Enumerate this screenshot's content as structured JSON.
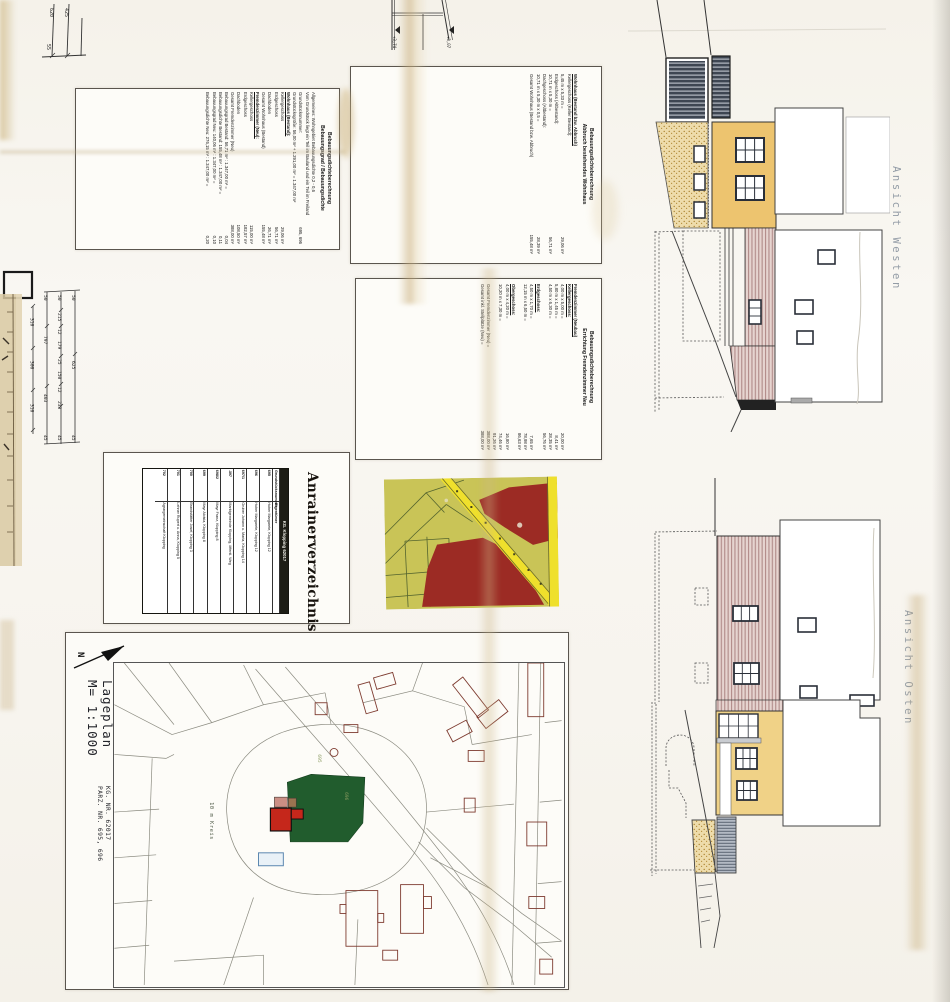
{
  "dims": {
    "t": [
      "620",
      "425",
      "55"
    ],
    "m1": [
      "310",
      "300",
      "310"
    ],
    "m2": [
      "50",
      "797",
      "403",
      "45"
    ],
    "m3": [
      "50",
      "215",
      "12",
      "179",
      "25",
      "150",
      "12",
      "233",
      "45"
    ],
    "m4": [
      "50",
      "625",
      "45"
    ]
  },
  "levels": [
    "+3,74",
    "+3,07"
  ],
  "panels": {
    "p1": {
      "title1": "Bebauungsdichteberechnung",
      "title2": "Bebauungsgrad / Bebauungsdichte",
      "rows": [
        {
          "t": "Allgemeines: Wohngebiet Bebauungsdichte 0,2 - 0,6",
          "v": ""
        },
        {
          "t": "Vom Grundstück liegt ein Teil im Bauland und ein Teil im Freiland",
          "v": ""
        },
        {
          "t": "Grundstücksnummer:",
          "v": "695, 696"
        },
        {
          "t": "Grundstücksgröße:  56,00 m² + 1.291,00 m² = 1.347,00 m²",
          "v": ""
        },
        {
          "t": "Wohnhaus (Bestand):",
          "v": "",
          "b": 1
        },
        {
          "t": "Kellergeschoss",
          "v": "29,06 m²"
        },
        {
          "t": "Erdgeschoss",
          "v": "56,71 m²"
        },
        {
          "t": "Dachboden",
          "v": "26,71 m²"
        },
        {
          "t": "Gesamt Wohnhaus (Bestand)",
          "v": "155,48 m²"
        },
        {
          "t": "Fremdenzimmer (Neu):",
          "v": "",
          "b": 1
        },
        {
          "t": "Kellergeschoss",
          "v": "115,00 m²"
        },
        {
          "t": "Erdgeschoss",
          "v": "182,57 m²"
        },
        {
          "t": "Dachboden",
          "v": "108,50 m²"
        },
        {
          "t": "Gesamt Fremdenzimmer (Neu)",
          "v": "388,00 m²"
        },
        {
          "t": "Bebauungsgrad Bestand:  56,71 m² : 1.347,00 m² =",
          "v": "0,04"
        },
        {
          "t": "Bebauungsdichte Bestand:  155,48 m² : 1.347,00 m² =",
          "v": "0,11"
        },
        {
          "t": "Bebauungsgrad Neu:  140,06 m² : 1.347,00 m² =",
          "v": "0,10"
        },
        {
          "t": "Bebauungsdichte Neu:  276,15 m² : 1.347,00 m² =",
          "v": "0,20"
        }
      ]
    },
    "p2": {
      "title1": "Bebauungsdichteberechnung",
      "title2": "Abbruch bestehendes Wohnhaus",
      "rows": [
        {
          "t": "Wohnhaus (Bestand bzw. Abbruch)",
          "v": "",
          "b": 1
        },
        {
          "t": "Kellergeschoss (Keller Bestand):",
          "v": ""
        },
        {
          "t": "5,45 m x 5,33 m =",
          "v": "29,06 m²"
        },
        {
          "t": "Erdgeschoss (Altbestand):",
          "v": ""
        },
        {
          "t": "10,71 m x 5,30 m =",
          "v": "56,71 m²"
        },
        {
          "t": "Dachgeschoss (Altbestand):",
          "v": ""
        },
        {
          "t": "10,71 m x 5,30 m x 0,5 =",
          "v": "28,39 m²"
        },
        {
          "t": "Gesamt Wohnhaus (Bestand bzw. Abbruch)",
          "v": "155,48 m²"
        }
      ]
    },
    "p3": {
      "title1": "Bebauungsdichteberechnung",
      "title2": "Errichtung Fremdenzimmer Neu",
      "rows": [
        {
          "t": "Fremdenzimmer (Neubau)",
          "v": "",
          "b": 1
        },
        {
          "t": "Kellergeschoss:",
          "v": "",
          "b": 1
        },
        {
          "t": "4,00 m x 5,00 m =",
          "v": "20,00 m²"
        },
        {
          "t": "5,80 m x 1,45 m =",
          "v": "8,41 m²"
        },
        {
          "t": "4,50 m x 6,30 m =",
          "v": "28,35 m²"
        },
        {
          "t": "",
          "v": "56,76 m²"
        },
        {
          "t": "Erdgeschoss:",
          "v": "",
          "b": 1
        },
        {
          "t": "4,50 m x 1,70 m =",
          "v": "7,65 m²"
        },
        {
          "t": "12,15 m x 6,50 m =",
          "v": "78,98 m²"
        },
        {
          "t": "",
          "v": "86,63 m²"
        },
        {
          "t": "Obergeschoss:",
          "v": "",
          "b": 1
        },
        {
          "t": "4,00 m x 4,20 m =",
          "v": "16,80 m²"
        },
        {
          "t": "10,20 m x 7,30 m =",
          "v": "74,46 m²"
        },
        {
          "t": "",
          "v": "91,26 m²"
        },
        {
          "t": "Gesamt Fremdenzimmer (Neu) =",
          "v": "388,00 m²"
        },
        {
          "t": "Gesamt inkl. Stellplätze (Neu) =",
          "v": "388,00 m²"
        }
      ]
    }
  },
  "anrainer": {
    "title": "Anrainerverzeichnis",
    "kg": "KG. Klopping 62017",
    "col1": "Grundstücksnummer",
    "col2": "Eigentümer",
    "rows": [
      {
        "nr": "695",
        "owner": "Huber Margarete, Klopping 12"
      },
      {
        "nr": "696",
        "owner": "Huber Margarete, Klopping 12"
      },
      {
        "nr": "697/1",
        "owner": "Gruber Johann u. Maria, Klopping 14"
      },
      {
        "nr": ".397",
        "owner": "Marktgemeinde Klopping, öffentl. Weg"
      },
      {
        "nr": "698/2",
        "owner": "Mayr Franz, Klopping 8"
      },
      {
        "nr": "699",
        "owner": "Mayr Aloisia, Klopping 8"
      },
      {
        "nr": "700",
        "owner": "Brandstätter Josef, Klopping 3"
      },
      {
        "nr": "701",
        "owner": "Lehner Rupert u. Anna, Klopping 5"
      },
      {
        "nr": "702",
        "owner": "Agrargemeinschaft Klopping"
      }
    ]
  },
  "lageplan": {
    "l1": "Lageplan",
    "l2": "M= 1:1000",
    "kg1": "KG. Klopping",
    "kg2": "KG. NR. 62017",
    "kg3": "PARZ. NR. 695, 696",
    "circle": "10 m Kreis",
    "parz1": "695",
    "parz2": "696",
    "north": "N"
  },
  "elevations": {
    "west": "Ansicht Westen",
    "east": "Ansicht Osten"
  },
  "colors": {
    "map_olive": "#c9c457",
    "map_red": "#9c2b24",
    "map_yellow": "#efe02c",
    "site_green": "#215c2d",
    "building_red": "#c5271b",
    "annex_pink": "#cc8f85",
    "marker_blue": "#5b87b0",
    "wall_tan": "#edc46f",
    "roof_pink": "#e6d4d0",
    "shutter_dark": "#3e4652",
    "stair_gray": "#b3bac4"
  }
}
